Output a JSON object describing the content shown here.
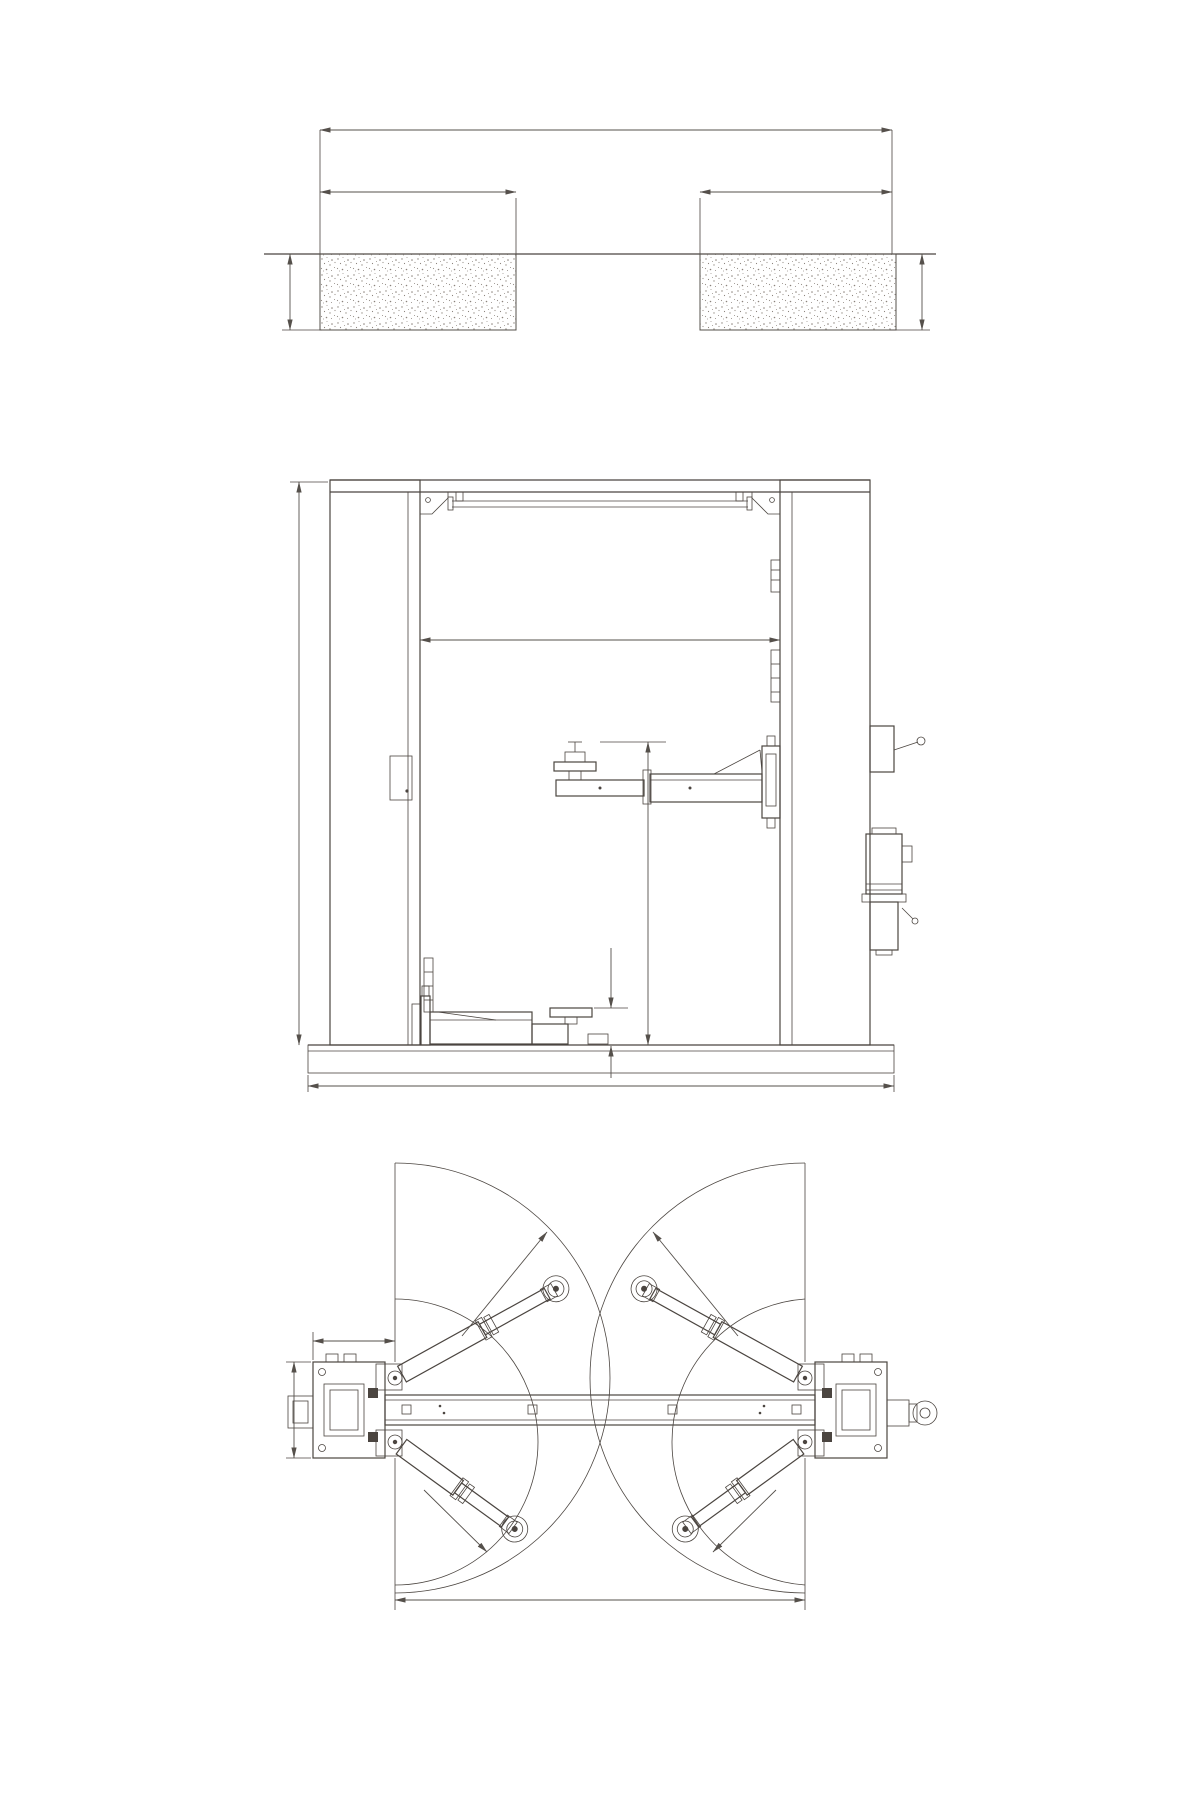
{
  "drawing": {
    "background": "#ffffff",
    "line_color": "#4b4540",
    "stipple_color": "#8b837c",
    "foundation_view": {
      "title": "地基图",
      "dim_overall_width": "3800",
      "dim_block_width_left": "800",
      "dim_block_width_right": "800",
      "label_block_left": "800见方",
      "label_ground": "地平面",
      "label_block_right": "800见方",
      "dim_depth_left": "500",
      "dim_depth_right": "500"
    },
    "front_view": {
      "dim_total_height": "3670",
      "dim_clear_width": "2790",
      "dim_lift_height": "1850",
      "dim_min_pad_height": "120",
      "dim_base_width": "3320"
    },
    "plan_view": {
      "title": "尺寸图",
      "dim_arm_offset": "360",
      "dim_base_depth": "460",
      "dim_post_span": "2500",
      "label_radius_front_left": "R1100",
      "label_radius_front_right": "R1100",
      "label_radius_rear_left": "R730",
      "label_radius_rear_right": "R730"
    }
  }
}
